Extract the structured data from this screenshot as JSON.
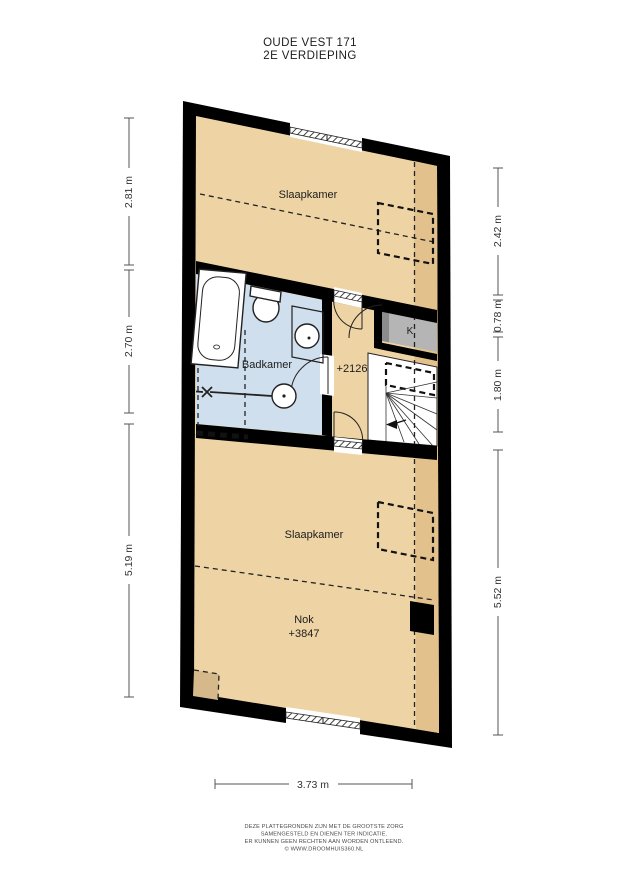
{
  "title": {
    "line1": "OUDE VEST 171",
    "line2": "2E VERDIEPING"
  },
  "plan": {
    "rooms": {
      "slaapkamer_top": {
        "label": "Slaapkamer"
      },
      "badkamer": {
        "label": "Badkamer"
      },
      "overloop": {
        "level_label": "+2126"
      },
      "kast": {
        "label": "K"
      },
      "slaapkamer_bottom": {
        "label": "Slaapkamer"
      },
      "nok": {
        "label": "Nok",
        "level_label": "+3847"
      }
    },
    "colors": {
      "wall": "#000000",
      "floor": "#eed4a4",
      "floor_shaded": "#e3c18c",
      "bathroom_floor": "#d0dfee",
      "closet": "#b5b5b5",
      "closet_door": "#8c8c8c",
      "chimney": "#d6b98b",
      "stairs": "#ffffff"
    }
  },
  "dimensions": {
    "left": [
      {
        "label": "2.81 m"
      },
      {
        "label": "2.70 m"
      },
      {
        "label": "5.19 m"
      }
    ],
    "right": [
      {
        "label": "2.42 m"
      },
      {
        "label": "0.78 m"
      },
      {
        "label": "1.80 m"
      },
      {
        "label": "5.52 m"
      }
    ],
    "bottom": {
      "label": "3.73 m"
    }
  },
  "footer": {
    "line1": "DEZE PLATTEGRONDEN ZIJN MET DE GROOTSTE ZORG",
    "line2": "SAMENGESTELD EN DIENEN TER INDICATIE.",
    "line3": "ER KUNNEN GEEN RECHTEN AAN WORDEN ONTLEEND.",
    "line4": "© WWW.DROOMHUIS360.NL"
  }
}
